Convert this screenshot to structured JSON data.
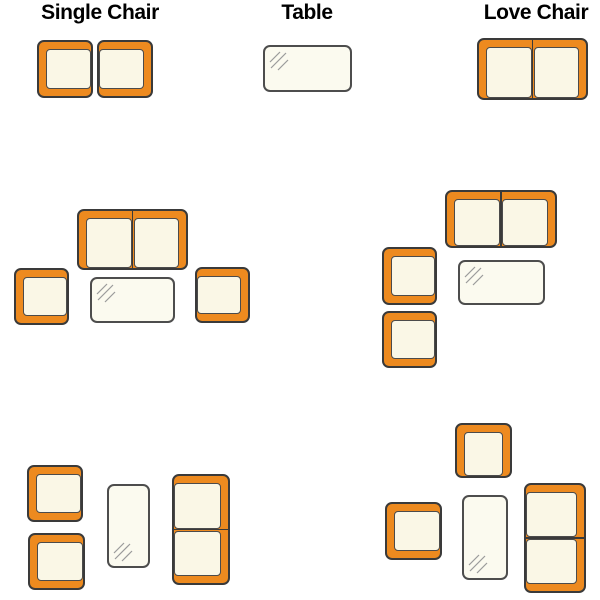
{
  "page": {
    "background": "#FFFFFF",
    "description_visible": false
  },
  "colors": {
    "background": "#FFFFFF",
    "frame_orange": "#ED8A1F",
    "frame_outline": "#3A3A3A",
    "cushion_fill": "#FAF7E6",
    "cushion_outline": "#4B4B4B",
    "table_fill": "#FBFAEF",
    "table_outline": "#4D4D4D",
    "shine_line": "#9A9A9A",
    "label_color": "#000000"
  },
  "legend": {
    "items": [
      {
        "label": "Single Chair",
        "center_x": 100
      },
      {
        "label": "Table",
        "center_x": 307
      },
      {
        "label": "Love Chair",
        "center_x": 536
      }
    ]
  },
  "groups": [
    {
      "name": "legend-single-chair-samples",
      "pieces": [
        {
          "type": "single-chair",
          "x": 37,
          "y": 40,
          "w": 56,
          "h": 58,
          "open": "right"
        },
        {
          "type": "single-chair",
          "x": 97,
          "y": 40,
          "w": 56,
          "h": 58,
          "open": "left"
        }
      ]
    },
    {
      "name": "legend-table-sample",
      "pieces": [
        {
          "type": "table",
          "x": 263,
          "y": 45,
          "w": 89,
          "h": 47,
          "shine": "top-left"
        }
      ]
    },
    {
      "name": "legend-love-chair-sample",
      "pieces": [
        {
          "type": "love-chair",
          "x": 477,
          "y": 38,
          "w": 111,
          "h": 62,
          "open": "bottom"
        }
      ]
    },
    {
      "name": "arrangement-middle-left",
      "pieces": [
        {
          "type": "love-chair",
          "x": 77,
          "y": 209,
          "w": 111,
          "h": 61,
          "open": "bottom"
        },
        {
          "type": "single-chair",
          "x": 14,
          "y": 268,
          "w": 55,
          "h": 57,
          "open": "right"
        },
        {
          "type": "table",
          "x": 90,
          "y": 277,
          "w": 85,
          "h": 46,
          "shine": "top-left"
        },
        {
          "type": "single-chair",
          "x": 195,
          "y": 267,
          "w": 55,
          "h": 56,
          "open": "left"
        }
      ]
    },
    {
      "name": "arrangement-middle-right",
      "pieces": [
        {
          "type": "love-chair",
          "x": 445,
          "y": 190,
          "w": 112,
          "h": 58,
          "open": "bottom"
        },
        {
          "type": "single-chair",
          "x": 382,
          "y": 247,
          "w": 55,
          "h": 58,
          "open": "right"
        },
        {
          "type": "single-chair",
          "x": 382,
          "y": 311,
          "w": 55,
          "h": 57,
          "open": "right"
        },
        {
          "type": "table",
          "x": 458,
          "y": 260,
          "w": 87,
          "h": 45,
          "shine": "top-left"
        }
      ]
    },
    {
      "name": "arrangement-bottom-left",
      "pieces": [
        {
          "type": "single-chair",
          "x": 27,
          "y": 465,
          "w": 56,
          "h": 57,
          "open": "right"
        },
        {
          "type": "single-chair",
          "x": 28,
          "y": 533,
          "w": 57,
          "h": 57,
          "open": "right"
        },
        {
          "type": "table",
          "x": 107,
          "y": 484,
          "w": 43,
          "h": 84,
          "shine": "bottom-left"
        },
        {
          "type": "love-chair",
          "x": 172,
          "y": 474,
          "w": 58,
          "h": 111,
          "open": "left"
        }
      ]
    },
    {
      "name": "arrangement-bottom-right",
      "pieces": [
        {
          "type": "single-chair",
          "x": 455,
          "y": 423,
          "w": 57,
          "h": 55,
          "open": "bottom"
        },
        {
          "type": "single-chair",
          "x": 385,
          "y": 502,
          "w": 57,
          "h": 58,
          "open": "right"
        },
        {
          "type": "table",
          "x": 462,
          "y": 495,
          "w": 46,
          "h": 85,
          "shine": "bottom-left"
        },
        {
          "type": "love-chair",
          "x": 524,
          "y": 483,
          "w": 62,
          "h": 110,
          "open": "left"
        }
      ]
    }
  ]
}
